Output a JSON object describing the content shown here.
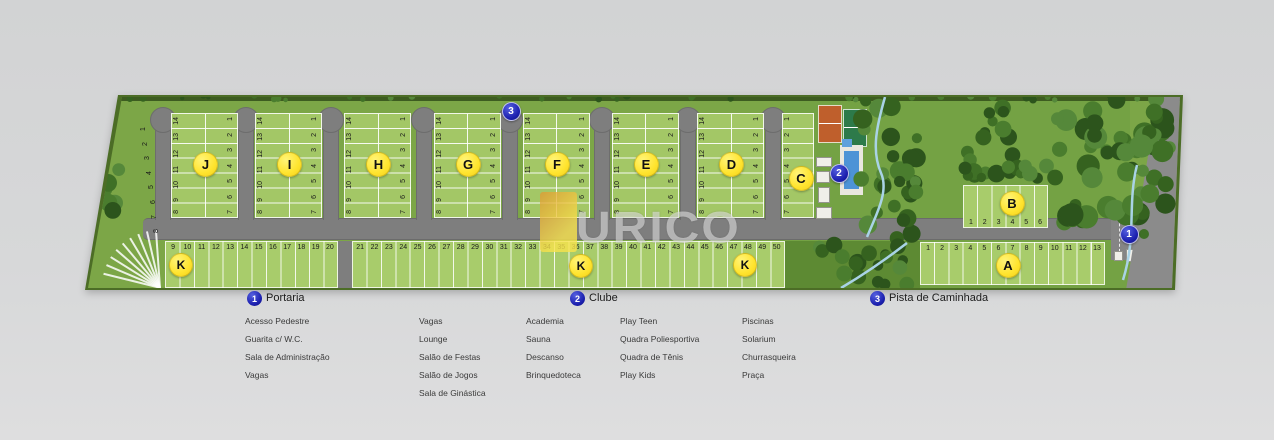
{
  "watermark": {
    "text": "URICO"
  },
  "plan": {
    "markers": [
      {
        "number": "1",
        "label": "Portaria"
      },
      {
        "number": "2",
        "label": "Clube"
      },
      {
        "number": "3",
        "label": "Pista de Caminhada"
      }
    ],
    "blocks": [
      {
        "letter": "J",
        "left_lots": [
          "14",
          "13",
          "12",
          "11",
          "10",
          "9",
          "8"
        ],
        "right_lots": [
          "1",
          "2",
          "3",
          "4",
          "5",
          "6",
          "7"
        ]
      },
      {
        "letter": "I",
        "left_lots": [
          "14",
          "13",
          "12",
          "11",
          "10",
          "9",
          "8"
        ],
        "right_lots": [
          "1",
          "2",
          "3",
          "4",
          "5",
          "6",
          "7"
        ]
      },
      {
        "letter": "H",
        "left_lots": [
          "14",
          "13",
          "12",
          "11",
          "10",
          "9",
          "8"
        ],
        "right_lots": [
          "1",
          "2",
          "3",
          "4",
          "5",
          "6",
          "7"
        ]
      },
      {
        "letter": "G",
        "left_lots": [
          "14",
          "13",
          "12",
          "11",
          "10",
          "9",
          "8"
        ],
        "right_lots": [
          "1",
          "2",
          "3",
          "4",
          "5",
          "6",
          "7"
        ]
      },
      {
        "letter": "F",
        "left_lots": [
          "14",
          "13",
          "12",
          "11",
          "10",
          "9",
          "8"
        ],
        "right_lots": [
          "1",
          "2",
          "3",
          "4",
          "5",
          "6",
          "7"
        ]
      },
      {
        "letter": "E",
        "left_lots": [
          "14",
          "13",
          "12",
          "11",
          "10",
          "9",
          "8"
        ],
        "right_lots": [
          "1",
          "2",
          "3",
          "4",
          "5",
          "6",
          "7"
        ]
      },
      {
        "letter": "D",
        "left_lots": [
          "14",
          "13",
          "12",
          "11",
          "10",
          "9",
          "8"
        ],
        "right_lots": [
          "1",
          "2",
          "3",
          "4",
          "5",
          "6",
          "7"
        ]
      }
    ],
    "block_c": {
      "letter": "C",
      "lots": [
        "1",
        "2",
        "3",
        "4",
        "5",
        "6",
        "7"
      ]
    },
    "block_b": {
      "letter": "B",
      "lots": [
        "1",
        "2",
        "3",
        "4",
        "5",
        "6"
      ]
    },
    "block_a": {
      "letter": "A",
      "lots": [
        "1",
        "2",
        "3",
        "4",
        "5",
        "6",
        "7",
        "8",
        "9",
        "10",
        "11",
        "12",
        "13"
      ]
    },
    "block_k": {
      "letter": "K",
      "edge_lots": [
        "1",
        "2",
        "3",
        "4",
        "5",
        "6",
        "7",
        "8"
      ],
      "strip_a": [
        "9",
        "10",
        "11",
        "12",
        "13",
        "14",
        "15",
        "16",
        "17",
        "18",
        "19",
        "20"
      ],
      "strip_b": [
        "21",
        "22",
        "23",
        "24",
        "25",
        "26",
        "27",
        "28",
        "29",
        "30",
        "31",
        "32",
        "33",
        "34",
        "35",
        "36",
        "37",
        "38",
        "39",
        "40",
        "41",
        "42",
        "43",
        "44",
        "45",
        "46",
        "47",
        "48",
        "49",
        "50"
      ]
    }
  },
  "legend": {
    "sections": [
      {
        "number": "1",
        "title": "Portaria",
        "columns": [
          [
            "Acesso Pedestre",
            "Guarita c/ W.C.",
            "Sala de Administração",
            "Vagas"
          ],
          [
            "Vagas",
            "Lounge",
            "Salão de Festas",
            "Salão de Jogos",
            "Sala de Ginástica"
          ]
        ]
      },
      {
        "number": "2",
        "title": "Clube",
        "columns": [
          [
            "Academia",
            "Sauna",
            "Descanso",
            "Brinquedoteca"
          ],
          [
            "Play Teen",
            "Quadra Poliesportiva",
            "Quadra de Tênis",
            "Play Kids"
          ],
          [
            "Piscinas",
            "Solarium",
            "Churrasqueira",
            "Praça"
          ]
        ]
      },
      {
        "number": "3",
        "title": "Pista de Caminhada",
        "columns": []
      }
    ]
  },
  "colors": {
    "background_gray": "#d6d7d8",
    "base_green": "#7ca647",
    "lot_green": "#a3c766",
    "road_gray": "#7e7e7e",
    "marker_blue": "#1b1fae",
    "block_circle_yellow": "#ffe42e",
    "court_orange": "#bf5f2c",
    "tennis_green": "#2d7a4a",
    "pool_blue": "#4d93d6",
    "watermark_yellow": "#f0c040"
  }
}
